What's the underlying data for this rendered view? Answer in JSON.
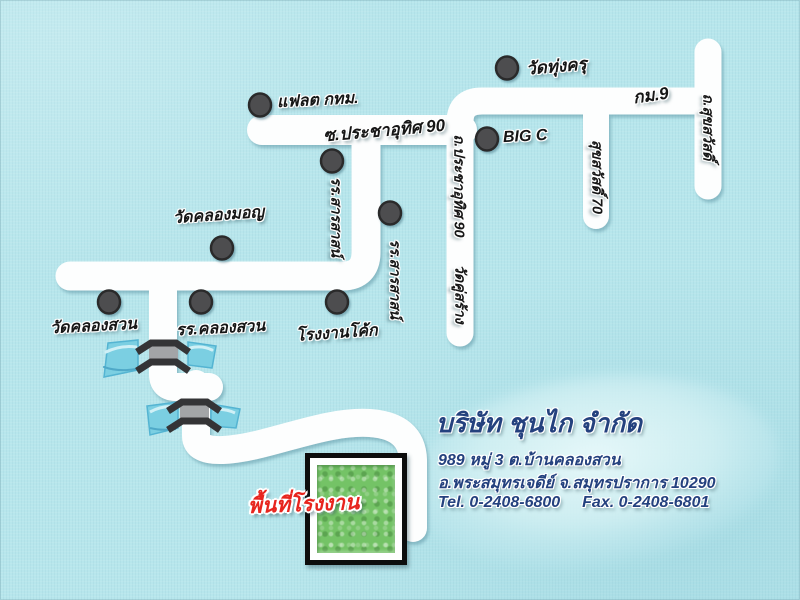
{
  "landmarks": [
    {
      "label": "แฟลต กทม."
    },
    {
      "label": "วัดทุ่งครุ"
    },
    {
      "label": "BIG C"
    },
    {
      "label": "รร.สารสาสน์"
    },
    {
      "label": "รร.สารสาสน์"
    },
    {
      "label": "วัดคลองมอญ"
    },
    {
      "label": "วัดคลองสวน"
    },
    {
      "label": "รร.คลองสวน"
    },
    {
      "label": "โรงงานโค้ก"
    }
  ],
  "road_labels": [
    {
      "label": "ซ.ประชาอุทิศ 90"
    },
    {
      "label": "กม.9"
    },
    {
      "label": "ถ.สุขสวัสดิ์"
    },
    {
      "label": "สุขสวัสดิ์ 70"
    },
    {
      "label": "ถ.ประชาอุทิศ 90"
    },
    {
      "label": "วัดคู่สร้าง"
    }
  ],
  "factory": {
    "area_label": "พื้นที่โรงงาน"
  },
  "company": {
    "name": "บริษัท ชุนไก จำกัด",
    "address1": "989 หมู่ 3 ต.บ้านคลองสวน",
    "address2": "อ.พระสมุทรเจดีย์ จ.สมุทรปราการ 10290",
    "tel": "Tel. 0-2408-6800",
    "fax": "Fax. 0-2408-6801"
  },
  "colors": {
    "background": "#b7e6ec",
    "road": "#fdfefe",
    "water": "#7bcfe2",
    "bridge_dark": "#343436",
    "bridge_deck": "#a3a5a7",
    "dot_gray": "#4e4e50",
    "factory_green": "#74c366",
    "label_red": "#e7251e",
    "company_navy": "#24417e"
  }
}
